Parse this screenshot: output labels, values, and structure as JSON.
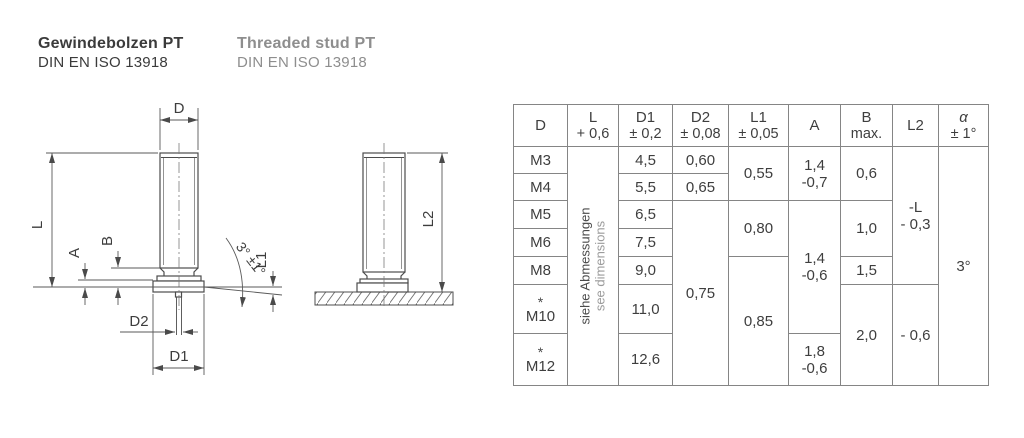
{
  "title": {
    "de_name": "Gewindebolzen PT",
    "de_standard": "DIN EN ISO 13918",
    "en_name": "Threaded stud PT",
    "en_standard": "DIN EN ISO 13918"
  },
  "diagram": {
    "labels": {
      "d": "D",
      "l": "L",
      "a": "A",
      "b": "B",
      "d2": "D2",
      "d1": "D1",
      "l1": "L1",
      "l2": "L2",
      "angle": "3° ±1°"
    }
  },
  "table": {
    "headers": {
      "d": {
        "l1": "D",
        "l2": ""
      },
      "l": {
        "l1": "L",
        "l2": "+ 0,6"
      },
      "d1": {
        "l1": "D1",
        "l2": "± 0,2"
      },
      "d2": {
        "l1": "D2",
        "l2": "± 0,08"
      },
      "l1": {
        "l1": "L1",
        "l2": "± 0,05"
      },
      "a": {
        "l1": "A",
        "l2": ""
      },
      "b": {
        "l1": "B",
        "l2": "max."
      },
      "l2c": {
        "l1": "L2",
        "l2": ""
      },
      "alpha": {
        "l1": "α",
        "l2": "± 1°"
      }
    },
    "rows": {
      "d": [
        "M3",
        "M4",
        "M5",
        "M6",
        "M8",
        "M10",
        "M12"
      ],
      "star": "*",
      "note_de": "siehe Abmessungen",
      "note_en": "see dimensions",
      "d1": [
        "4,5",
        "5,5",
        "6,5",
        "7,5",
        "9,0",
        "11,0",
        "12,6"
      ],
      "d2": {
        "m3": "0,60",
        "m4": "0,65",
        "rest": "0,75"
      },
      "l1": {
        "g1": "0,55",
        "g2": "0,80",
        "g3": "0,85"
      },
      "a": {
        "g1a": "1,4",
        "g1b": "-0,7",
        "g2a": "1,4",
        "g2b": "-0,6",
        "g3a": "1,8",
        "g3b": "-0,6"
      },
      "b": {
        "g1": "0,6",
        "g2": "1,0",
        "g3": "1,5",
        "g4": "2,0"
      },
      "l2": {
        "g1a": "-L",
        "g1b": "- 0,3",
        "g2": "- 0,6"
      },
      "alpha": "3°"
    }
  }
}
